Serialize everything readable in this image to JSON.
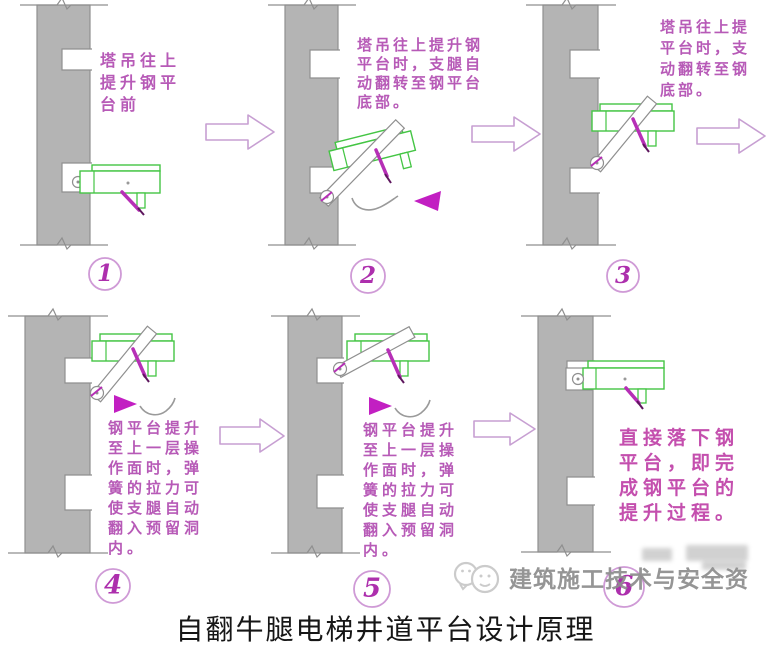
{
  "caption": "自翻牛腿电梯井道平台设计原理",
  "steps": [
    {
      "number": "1",
      "note": "塔吊往上\n提升钢平\n台前"
    },
    {
      "number": "2",
      "note": "塔吊往上提升钢\n平台时，支腿自\n动翻转至钢平台\n底部。"
    },
    {
      "number": "3",
      "note": "塔吊往上提\n平台时，支\n动翻转至钢\n底部。"
    },
    {
      "number": "4",
      "note": "钢平台提升\n至上一层操\n作面时，弹\n簧的拉力可\n使支腿自动\n翻入预留洞\n内。"
    },
    {
      "number": "5",
      "note": "钢平台提升\n至上一层操\n作面时，弹\n簧的拉力可\n使支腿自动\n翻入预留洞\n内。"
    },
    {
      "number": "6",
      "note": "直接落下钢\n平台，即完\n成钢平台的\n提升过程。"
    }
  ],
  "watermark": {
    "text": "建筑施工技术与安全资",
    "logo": "chat-bubbles-logo"
  },
  "colors": {
    "wall_fill": "#b4b4b4",
    "wall_stroke": "#8f8f8f",
    "platform_green": "#44c544",
    "annotation_magenta": "#b75ab7",
    "step6_magenta": "#c44fae",
    "spring_magenta": "#b62fb6",
    "arrow_outline": "#c79fd2",
    "badge_digit": "#ad2fad",
    "caption_text": "#161616",
    "watermark_gray": "#8d8d8d"
  }
}
